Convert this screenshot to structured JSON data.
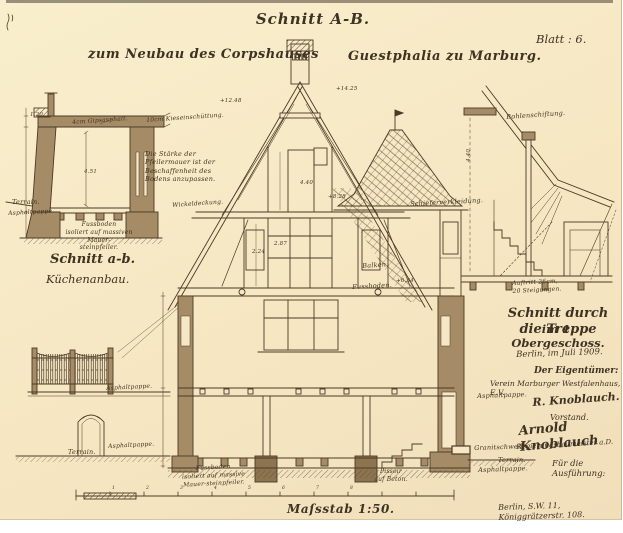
{
  "header": {
    "title": "Schnitt A-B.",
    "subtitle_left": "zum Neubau des Corpshauses",
    "subtitle_right": "Guestphalia zu Marburg.",
    "sheet_no": "Blatt : 6."
  },
  "kitchen_section": {
    "caption1": "Schnitt a-b.",
    "caption2": "Küchenanbau."
  },
  "stair_section": {
    "caption1": "Schnitt durch die Treppe",
    "caption2": "im 1. Obergeschoss."
  },
  "title_block": {
    "date": "Berlin, im Juli 1909.",
    "owner_heading": "Der Eigentümer:",
    "owner": "Verein Marburger Westfalenhaus, E.V.",
    "signature1": "R. Knoblauch.",
    "signature1_role": "Vorstand.",
    "signature2": "Arnold Knoblauch",
    "signature2_role": "Regierungsbaumeister a.D.",
    "execution_heading": "Für die Ausführung:",
    "address": "Berlin, S.W. 11, Königgrätzerstr. 108."
  },
  "scale": {
    "label": "Maſsstab 1:50."
  },
  "colors": {
    "paper": "#f6e7c4",
    "ink": "#4a3a26",
    "wall_fill": "#a58c66"
  },
  "annotations": [
    {
      "name": "label-gipsasphalt",
      "text": "4cm Gipsasphalt.",
      "x": 72,
      "y": 119,
      "fs": 6,
      "rot": -4
    },
    {
      "name": "label-kieseinschuettung",
      "text": "10cm Kieseinschüttung.",
      "x": 146,
      "y": 117,
      "fs": 6,
      "rot": -4
    },
    {
      "name": "note-pfeilermauer",
      "text": "Die Stärke der\nPfeilermauer ist der\nBeschaffenheit des\nBodens anzupassen.",
      "x": 145,
      "y": 150,
      "fs": 6.5
    },
    {
      "name": "label-wickeldeckung",
      "text": "Wickeldeckung.",
      "x": 172,
      "y": 202,
      "fs": 6,
      "rot": -4
    },
    {
      "name": "label-terrain-annex",
      "text": "Terrain.",
      "x": 12,
      "y": 198,
      "fs": 6.5
    },
    {
      "name": "label-asphaltpappe-annex",
      "text": "Asphaltpappe.",
      "x": 8,
      "y": 210,
      "fs": 6,
      "rot": -3
    },
    {
      "name": "note-fussboden-annex",
      "text": "Fussboden\nisoliert auf massiven Mauer-\nsteinpfeiler.",
      "x": 54,
      "y": 221,
      "fs": 6,
      "w": 90
    },
    {
      "name": "label-schieferverkleidung",
      "text": "Schieferverkleidung.",
      "x": 410,
      "y": 200,
      "fs": 6.5,
      "rot": -3
    },
    {
      "name": "label-balken",
      "text": "Balken.",
      "x": 362,
      "y": 262,
      "fs": 6.5,
      "rot": -4
    },
    {
      "name": "label-fussboden-main",
      "text": "Fussboden.",
      "x": 352,
      "y": 283,
      "fs": 6.5,
      "rot": -3
    },
    {
      "name": "label-bohlenschiftung",
      "text": "Bohlenschiftung.",
      "x": 506,
      "y": 113,
      "fs": 6.5,
      "rot": -4
    },
    {
      "name": "label-auftritt",
      "text": "Auftritt 26cm,\n20 Steigungen.",
      "x": 512,
      "y": 280,
      "fs": 6,
      "rot": -3
    },
    {
      "name": "label-asphaltpappe-right",
      "text": "Asphaltpappe.",
      "x": 477,
      "y": 392,
      "fs": 6.5,
      "rot": -2
    },
    {
      "name": "label-granitschwelle",
      "text": "Granitschwelle.",
      "x": 474,
      "y": 444,
      "fs": 6.5,
      "rot": -2
    },
    {
      "name": "label-terrain-right",
      "text": "Terrain.",
      "x": 498,
      "y": 456,
      "fs": 6.5
    },
    {
      "name": "label-asphaltpappe-right2",
      "text": "Asphaltpappe.",
      "x": 478,
      "y": 466,
      "fs": 6.5,
      "rot": -2
    },
    {
      "name": "label-asphaltpappe-fence",
      "text": "Asphaltpappe.",
      "x": 106,
      "y": 385,
      "fs": 6,
      "rot": -3
    },
    {
      "name": "label-asphaltpappe-fence2",
      "text": "Asphaltpappe.",
      "x": 108,
      "y": 443,
      "fs": 6,
      "rot": -3
    },
    {
      "name": "label-terrain-fence",
      "text": "Terrain.",
      "x": 68,
      "y": 448,
      "fs": 6.5
    },
    {
      "name": "note-fussboden-bottom",
      "text": "Fussboden\nisoliert auf massive\nMauer-steinpfeiler.",
      "x": 176,
      "y": 466,
      "fs": 6,
      "rot": -3,
      "w": 74
    },
    {
      "name": "label-pissoir",
      "text": "Pissoir\nauf Beton.",
      "x": 372,
      "y": 468,
      "fs": 6,
      "w": 38
    },
    {
      "name": "dim-label",
      "text": "4.51",
      "x": 84,
      "y": 169,
      "fs": 5.5
    },
    {
      "name": "dim-label",
      "text": "1.20",
      "x": 30,
      "y": 112,
      "fs": 5.5
    },
    {
      "name": "dim-label",
      "text": "+14.25",
      "x": 336,
      "y": 86,
      "fs": 5.5
    },
    {
      "name": "dim-label",
      "text": "+12.48",
      "x": 220,
      "y": 98,
      "fs": 5.5
    },
    {
      "name": "dim-label",
      "text": "+8.28",
      "x": 328,
      "y": 194,
      "fs": 5.5
    },
    {
      "name": "dim-label",
      "text": "4.40",
      "x": 300,
      "y": 180,
      "fs": 5.5
    },
    {
      "name": "dim-label",
      "text": "2.87",
      "x": 274,
      "y": 241,
      "fs": 5.5
    },
    {
      "name": "dim-label",
      "text": "2.24",
      "x": 252,
      "y": 249,
      "fs": 5.5
    },
    {
      "name": "dim-label",
      "text": "+6.34",
      "x": 396,
      "y": 278,
      "fs": 5.5
    },
    {
      "name": "dim-label",
      "text": "4.40",
      "x": 466,
      "y": 162,
      "fs": 5.5,
      "rot": -90
    },
    {
      "name": "scale-tick-label",
      "text": "1",
      "x": 112,
      "y": 486,
      "fs": 4.5
    },
    {
      "name": "scale-tick-label",
      "text": "2",
      "x": 146,
      "y": 486,
      "fs": 4.5
    },
    {
      "name": "scale-tick-label",
      "text": "3",
      "x": 180,
      "y": 486,
      "fs": 4.5
    },
    {
      "name": "scale-tick-label",
      "text": "4",
      "x": 214,
      "y": 486,
      "fs": 4.5
    },
    {
      "name": "scale-tick-label",
      "text": "5",
      "x": 248,
      "y": 486,
      "fs": 4.5
    },
    {
      "name": "scale-tick-label",
      "text": "6",
      "x": 282,
      "y": 486,
      "fs": 4.5
    },
    {
      "name": "scale-tick-label",
      "text": "7",
      "x": 316,
      "y": 486,
      "fs": 4.5
    },
    {
      "name": "scale-tick-label",
      "text": "8",
      "x": 350,
      "y": 486,
      "fs": 4.5
    }
  ]
}
